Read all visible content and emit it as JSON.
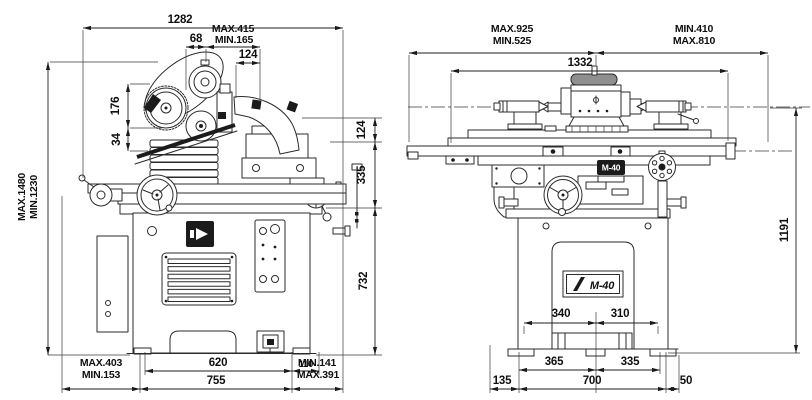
{
  "side_view": {
    "dims": {
      "overall_width": "1282",
      "belt_offset": "68",
      "wheelhead_max": "MAX.415",
      "wheelhead_min": "MIN.165",
      "pulley_offset": "124",
      "col_upper": "176",
      "col_lower": "34",
      "height_max": "MAX.1480",
      "height_min": "MIN.1230",
      "r_upper": "124",
      "r_mid": "335",
      "r_lower": "732",
      "overhang_left_max": "MAX.403",
      "overhang_left_min": "MIN.153",
      "feet_span": "620",
      "foot_offset": "110",
      "base_width": "755",
      "overhang_right_min": "MIN.141",
      "overhang_right_max": "MAX.391"
    }
  },
  "front_view": {
    "dims": {
      "travel_left_max": "MAX.925",
      "travel_left_min": "MIN.525",
      "travel_right_min": "MIN.410",
      "travel_right_max": "MAX.810",
      "table_length": "1332",
      "center_height": "1191",
      "slot_left": "340",
      "slot_right": "310",
      "foot_left": "365",
      "foot_right": "335",
      "margin_left": "135",
      "base_width": "700",
      "margin_right": "50"
    },
    "labels": {
      "saddle_badge": "M-40",
      "nameplate": "M-40"
    }
  }
}
